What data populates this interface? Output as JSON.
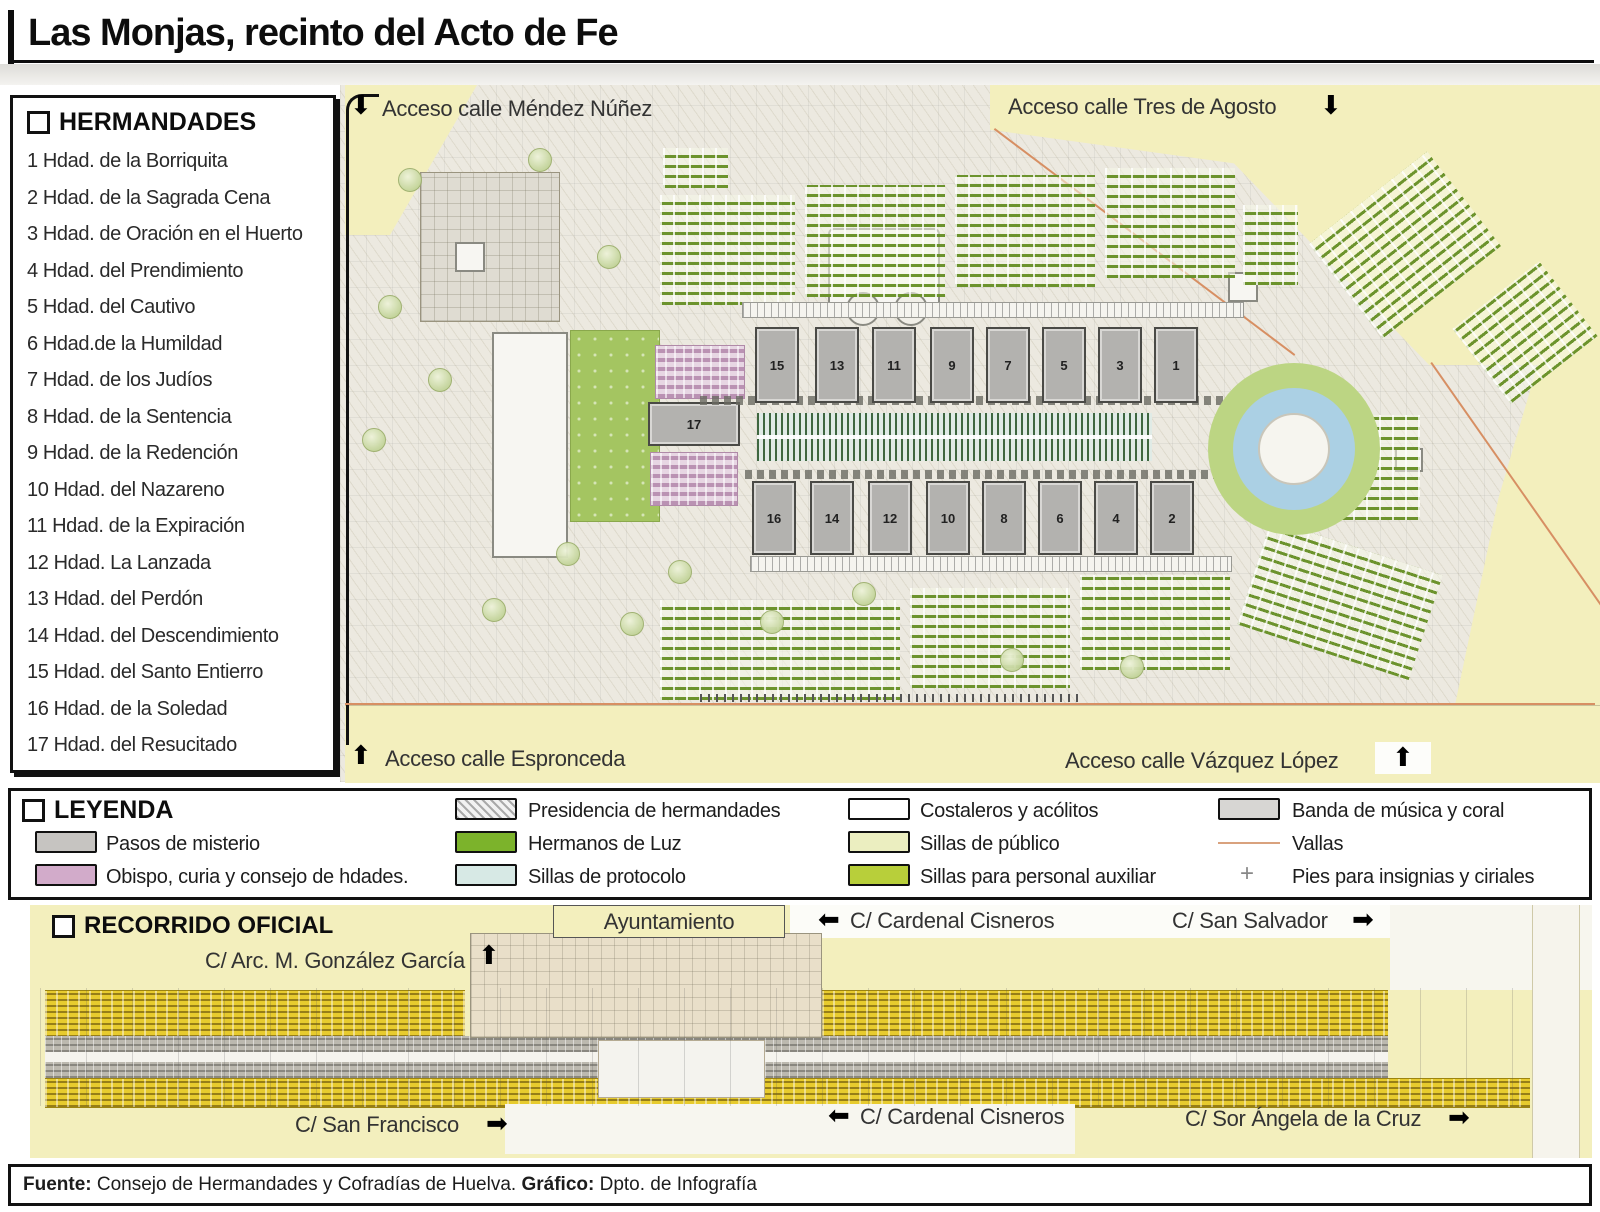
{
  "title": "Las Monjas, recinto del Acto de Fe",
  "icons": {
    "arrow_up": "⬆",
    "arrow_down": "⬇",
    "arrow_left": "⬅",
    "arrow_right": "➡",
    "cross": "+"
  },
  "hermandades": {
    "title": "HERMANDADES",
    "items": [
      "1 Hdad. de la Borriquita",
      "2 Hdad. de la Sagrada Cena",
      "3 Hdad. de Oración en el Huerto",
      "4 Hdad. del Prendimiento",
      "5 Hdad. del Cautivo",
      "6 Hdad.de la Humildad",
      "7 Hdad. de los Judíos",
      "8 Hdad. de la Sentencia",
      "9 Hdad. de la Redención",
      "10 Hdad. del Nazareno",
      "11 Hdad. de la Expiración",
      "12 Hdad. La Lanzada",
      "13 Hdad. del Perdón",
      "14 Hdad. del Descendimiento",
      "15 Hdad. del Santo Entierro",
      "16 Hdad. de la Soledad",
      "17 Hdad. del Resucitado"
    ]
  },
  "map": {
    "access": {
      "top_left": "Acceso calle Méndez Núñez",
      "top_right": "Acceso calle Tres de Agosto",
      "bottom_left": "Acceso calle Espronceda",
      "bottom_right": "Acceso calle Vázquez López"
    },
    "pasos_top": [
      "15",
      "13",
      "11",
      "9",
      "7",
      "5",
      "3",
      "1"
    ],
    "pasos_bottom": [
      "16",
      "14",
      "12",
      "10",
      "8",
      "6",
      "4",
      "2"
    ],
    "paso_separate": "17"
  },
  "legend": {
    "title": "LEYENDA",
    "items": [
      {
        "label": "Pasos de misterio",
        "swatch_color": "#c6c4c1"
      },
      {
        "label": "Obispo, curia y consejo de hdades.",
        "swatch_color": "#d2abca"
      },
      {
        "label": "Presidencia de hermandades",
        "swatch_color": "hatched-gray"
      },
      {
        "label": "Hermanos de Luz",
        "swatch_color": "#7cb32b"
      },
      {
        "label": "Sillas de protocolo",
        "swatch_color": "#d7e9e5"
      },
      {
        "label": "Costaleros y acólitos",
        "swatch_color": "#ffffff"
      },
      {
        "label": "Sillas de público",
        "swatch_color": "#ebeec0"
      },
      {
        "label": "Sillas para personal auxiliar",
        "swatch_color": "#b8cf3a"
      },
      {
        "label": "Banda de música y coral",
        "swatch_color": "#d7d6d3"
      },
      {
        "label": "Vallas",
        "swatch_color": "#d9a27e"
      },
      {
        "label": "Pies para insignias y ciriales",
        "swatch_color": "#888888"
      }
    ]
  },
  "recorrido": {
    "title": "RECORRIDO OFICIAL",
    "labels": {
      "ayuntamiento": "Ayuntamiento",
      "gonzalez_garcia": "C/ Arc. M. González García",
      "cardenal_cisneros_top": "C/ Cardenal Cisneros",
      "san_salvador": "C/ San Salvador",
      "san_francisco": "C/ San Francisco",
      "cardenal_cisneros_bottom": "C/ Cardenal Cisneros",
      "sor_angela": "C/ Sor Ángela de la Cruz"
    }
  },
  "footer": {
    "source_label": "Fuente:",
    "source_text": " Consejo de Hermandades y Cofradías de Huelva. ",
    "credit_label": "Gráfico:",
    "credit_text": " Dpto. de Infografía"
  },
  "colors": {
    "gold_stands": "#e7cb2e",
    "pale_yellow_road": "#f3efbd",
    "green_seats": "#7cb32b",
    "protocol_blue": "#d7e9e5",
    "bishop_pink": "#d2abca",
    "paso_gray": "#b3b2af",
    "valla_line": "#d78f63"
  }
}
